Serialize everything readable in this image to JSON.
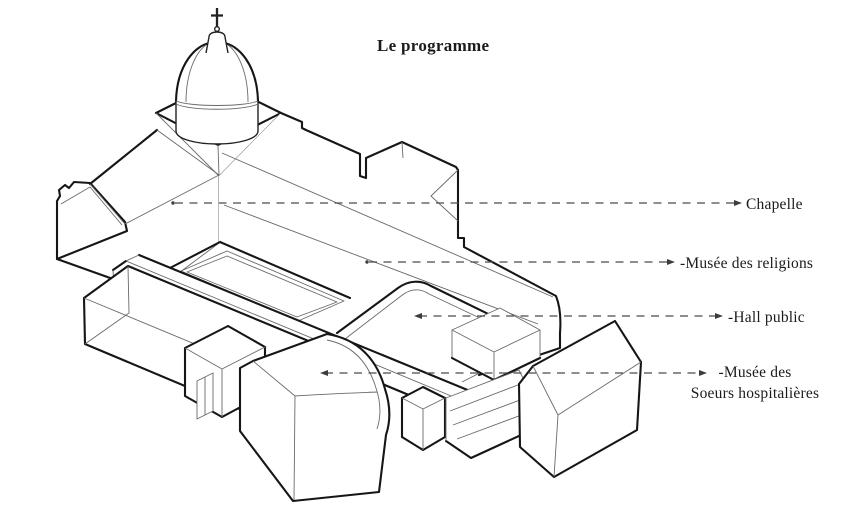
{
  "title": "Le programme",
  "diagram": {
    "type": "axonometric-architectural-line-drawing",
    "annotations": [
      {
        "id": "chapelle",
        "label": "Chapelle"
      },
      {
        "id": "musee-religions",
        "label": "-Musée des religions"
      },
      {
        "id": "hall-public",
        "label": "-Hall public"
      },
      {
        "id": "musee-soeurs",
        "label_line1": "-Musée des",
        "label_line2": "Soeurs hospitalières"
      }
    ],
    "colors": {
      "background": "#ffffff",
      "outline": "#161616",
      "thin_line": "#6a6a6a",
      "leader_line": "#4a4a4a",
      "text": "#1b1b1b"
    }
  }
}
